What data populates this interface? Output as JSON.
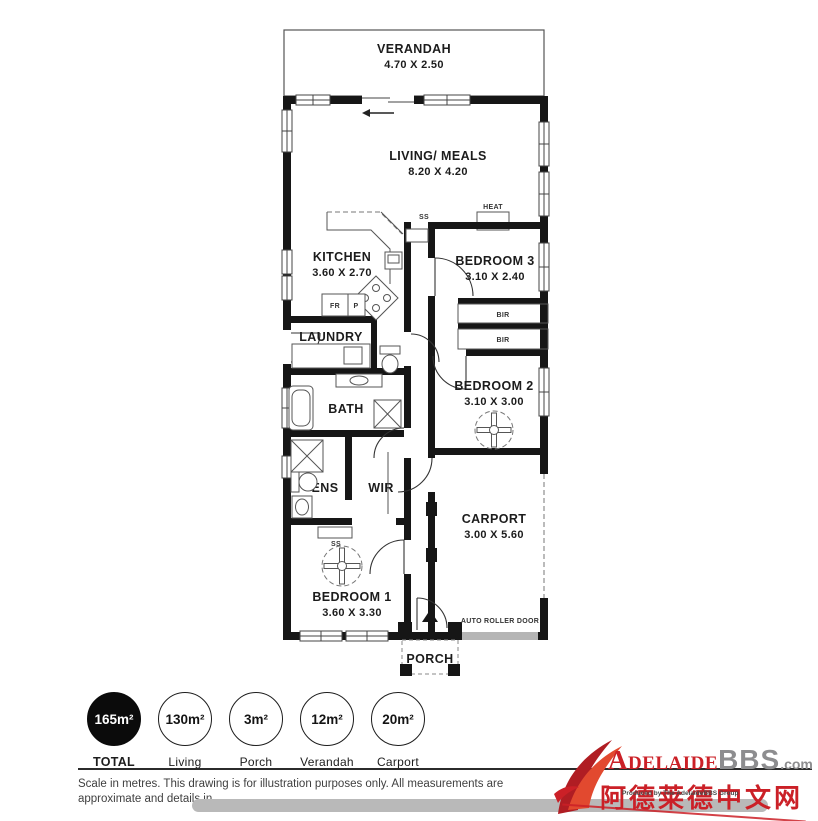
{
  "plan": {
    "verandah_label": "VERANDAH",
    "verandah_dims": "4.70 X 2.50",
    "living_label": "LIVING/ MEALS",
    "living_dims": "8.20 X 4.20",
    "kitchen_label": "KITCHEN",
    "kitchen_dims": "3.60 X 2.70",
    "bedroom3_label": "BEDROOM 3",
    "bedroom3_dims": "3.10 X 2.40",
    "bedroom2_label": "BEDROOM 2",
    "bedroom2_dims": "3.10 X 3.00",
    "bedroom1_label": "BEDROOM 1",
    "bedroom1_dims": "3.60 X 3.30",
    "carport_label": "CARPORT",
    "carport_dims": "3.00 X 5.60",
    "laundry_label": "LAUNDRY",
    "bath_label": "BATH",
    "ens_label": "ENS",
    "wir_label": "WIR",
    "porch_label": "PORCH",
    "heat_label": "HEAT",
    "bir_label_1": "BIR",
    "bir_label_2": "BIR",
    "ss_label_1": "SS",
    "ss_label_2": "SS",
    "fridge_label": "FR",
    "pantry_label": "P",
    "auto_roller_door_label": "AUTO ROLLER DOOR"
  },
  "legend": {
    "items": [
      {
        "value": "165m²",
        "label": "TOTAL",
        "filled": true
      },
      {
        "value": "130m²",
        "label": "Living",
        "filled": false
      },
      {
        "value": "3m²",
        "label": "Porch",
        "filled": false
      },
      {
        "value": "12m²",
        "label": "Verandah",
        "filled": false
      },
      {
        "value": "20m²",
        "label": "Carport",
        "filled": false
      }
    ]
  },
  "footer": {
    "disclaimer_line1": "Scale in metres. This drawing is for illustration purposes only. All measurements are",
    "disclaimer_line2": "approximate and details in"
  },
  "watermark": {
    "brand_main": "Adelaide",
    "brand_suffix": "BBS",
    "brand_tld": ".com",
    "chinese_text": "阿德莱德中文网",
    "tagline": "Produced by The AdelaideBBS Group"
  },
  "colors": {
    "wall": "#161616",
    "accent_red": "#cb2027",
    "brand_gray": "#8d8d8f",
    "roller_door_gray": "#b5b5b5"
  }
}
